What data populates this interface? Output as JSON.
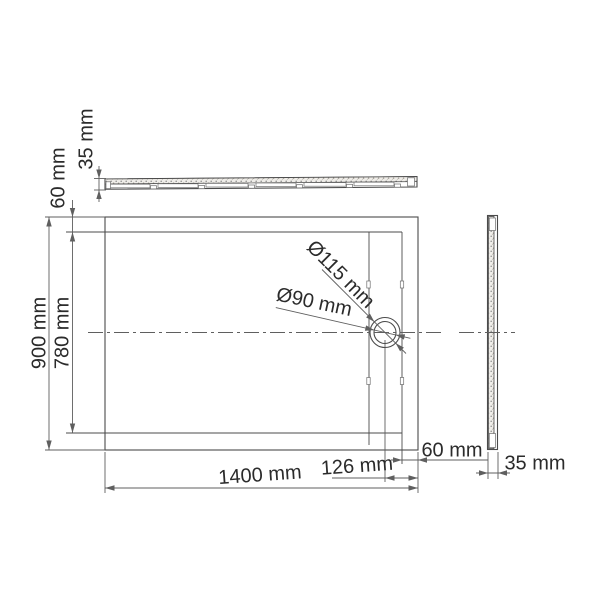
{
  "title": "shower-tray-dimension-drawing",
  "labels": {
    "top_view_thickness": "35 mm",
    "left_rim_inset": "60 mm",
    "outer_depth": "900 mm",
    "inner_depth": "780 mm",
    "drain_outer_diameter": "Ø115 mm",
    "drain_inner_diameter": "Ø90 mm",
    "outer_width": "1400 mm",
    "drain_center_offset": "126 mm",
    "right_rim_inset": "60 mm",
    "side_view_thickness": "35 mm"
  },
  "colors": {
    "background": "#ffffff",
    "line": "#4b4b4b",
    "dim": "#5f5f5f",
    "text": "#2b2b2b",
    "stipple": "#8d8d8d"
  }
}
